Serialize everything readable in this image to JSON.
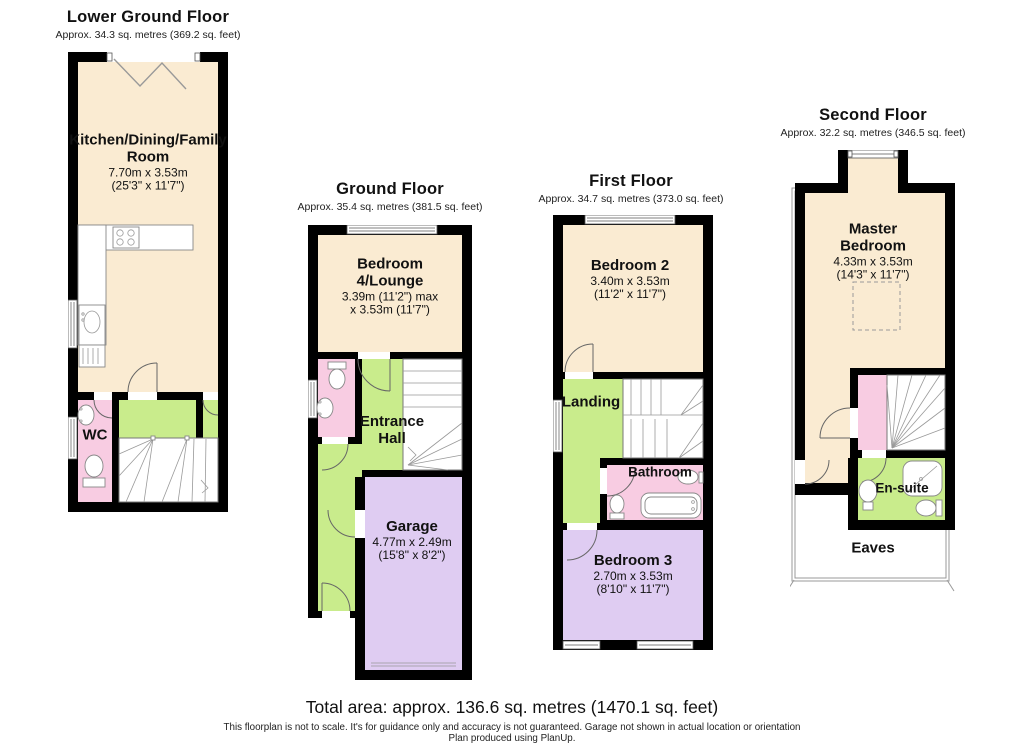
{
  "colors": {
    "cream": "#FAEBD2",
    "green": "#C9EC8C",
    "pink": "#F8CCE2",
    "purple": "#DFCCF2",
    "wall": "#000000"
  },
  "floors": {
    "lower_ground": {
      "title": "Lower Ground Floor",
      "subtitle": "Approx. 34.3 sq. metres (369.2 sq. feet)",
      "rooms": {
        "kitchen": {
          "name": "Kitchen/Dining/Family Room",
          "dim_m": "7.70m x 3.53m",
          "dim_ft": "(25'3\" x 11'7\")"
        },
        "wc": {
          "name": "WC"
        }
      }
    },
    "ground": {
      "title": "Ground Floor",
      "subtitle": "Approx. 35.4 sq. metres (381.5 sq. feet)",
      "rooms": {
        "bedroom4": {
          "name": "Bedroom 4/Lounge",
          "dim_m": "3.39m (11'2\") max",
          "dim_ft": "x 3.53m (11'7\")"
        },
        "entrance_hall": {
          "name": "Entrance Hall"
        },
        "garage": {
          "name": "Garage",
          "dim_m": "4.77m x 2.49m",
          "dim_ft": "(15'8\" x 8'2\")"
        }
      }
    },
    "first": {
      "title": "First Floor",
      "subtitle": "Approx. 34.7 sq. metres (373.0 sq. feet)",
      "rooms": {
        "bedroom2": {
          "name": "Bedroom 2",
          "dim_m": "3.40m x 3.53m",
          "dim_ft": "(11'2\" x 11'7\")"
        },
        "landing": {
          "name": "Landing"
        },
        "bathroom": {
          "name": "Bathroom"
        },
        "bedroom3": {
          "name": "Bedroom 3",
          "dim_m": "2.70m x 3.53m",
          "dim_ft": "(8'10\" x 11'7\")"
        }
      }
    },
    "second": {
      "title": "Second Floor",
      "subtitle": "Approx. 32.2 sq. metres (346.5 sq. feet)",
      "rooms": {
        "master": {
          "name": "Master Bedroom",
          "dim_m": "4.33m x 3.53m",
          "dim_ft": "(14'3\" x 11'7\")"
        },
        "ensuite": {
          "name": "En-suite"
        },
        "eaves": {
          "name": "Eaves"
        }
      }
    }
  },
  "footer": {
    "total_area": "Total area: approx. 136.6 sq. metres (1470.1 sq. feet)",
    "disclaimer1": "This floorplan is not to scale. It's for guidance only and accuracy is not guaranteed. Garage not shown in actual location or orientation",
    "disclaimer2": "Plan produced using PlanUp."
  }
}
